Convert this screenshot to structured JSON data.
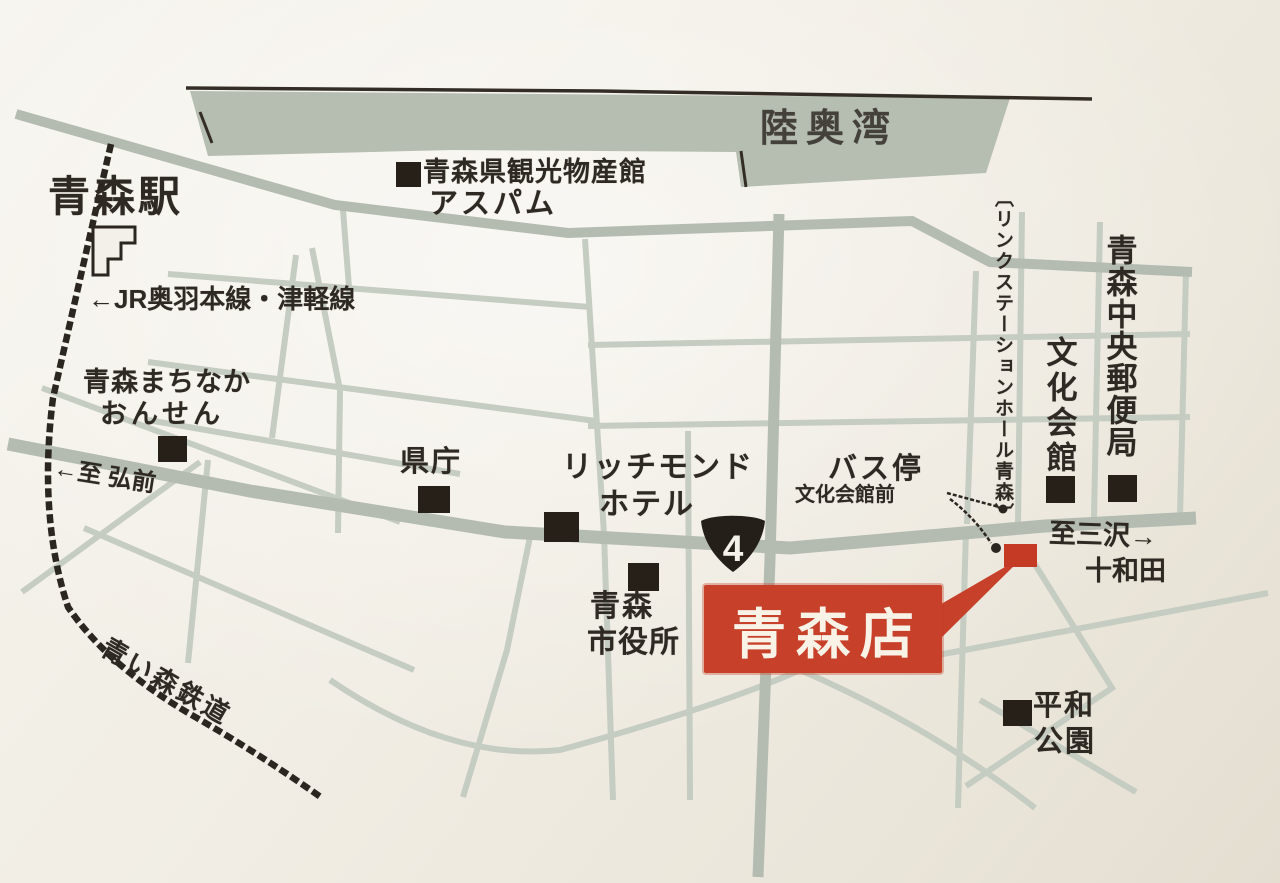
{
  "map": {
    "region_labels": {
      "mutsu_bay": "陸奥湾",
      "to_hirosaki": "←至 弘前",
      "to_misawa_line1": "至三沢→",
      "to_misawa_line2": "十和田"
    },
    "railways": {
      "station": "青森駅",
      "jr_line": "←JR奥羽本線・津軽線",
      "aoimori_railway": "青い森鉄道"
    },
    "landmarks": {
      "aspam_line1": "青森県観光物産館",
      "aspam_line2": "アスパム",
      "machinaka_line1": "青森まちなか",
      "machinaka_line2": "おんせん",
      "kencho": "県庁",
      "richmond_line1": "リッチモンド",
      "richmond_line2": "ホテル",
      "cityhall_line1": "青森",
      "cityhall_line2": "市役所",
      "busstop_line1": "バス停",
      "busstop_line2": "文化会館前",
      "link_station_hall": "〔リンクステーションホール青森〕",
      "bunka_kaikan": "文化会館",
      "post_office": "青森中央郵便局",
      "heiwa_line1": "平和",
      "heiwa_line2": "公園"
    },
    "route_badge": "4",
    "store_label": "青森店",
    "colors": {
      "sea": "#b6beb1",
      "road_major": "#b4bcb2",
      "road_minor": "#c5ccc2",
      "ink": "#2b2620",
      "accent_red": "#c7402a",
      "paper": "#f0ece3"
    }
  }
}
